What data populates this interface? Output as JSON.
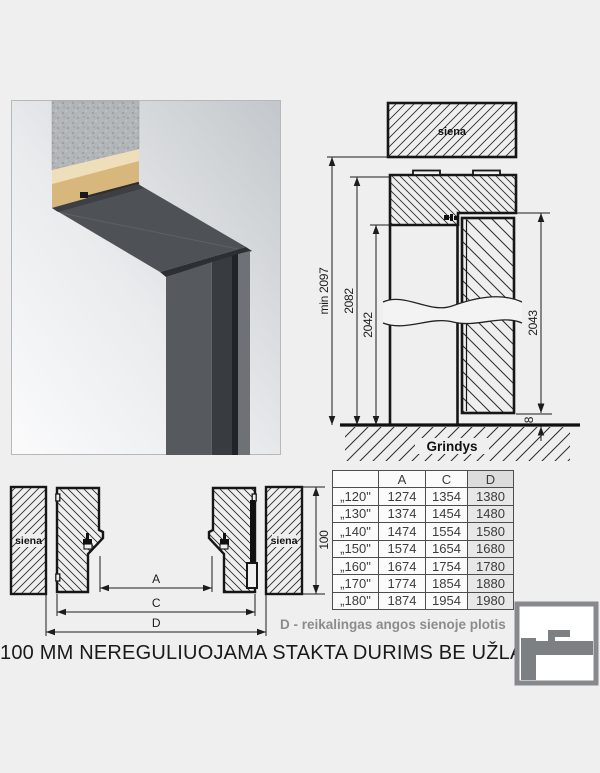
{
  "section_view": {
    "wall_label": "siena",
    "floor_label": "Grindys",
    "dims": {
      "min_total_height": "min 2097",
      "frame_outer_height": "2082",
      "clear_opening_height": "2042",
      "door_leaf_height": "2043",
      "floor_gap": "8"
    }
  },
  "plan_view": {
    "wall_label_left": "siena",
    "wall_label_right": "siena",
    "frame_depth": "100",
    "dim_a_label": "A",
    "dim_c_label": "C",
    "dim_d_label": "D"
  },
  "size_table": {
    "headers": [
      "",
      "A",
      "C",
      "D"
    ],
    "rows": [
      {
        "size": "„120\"",
        "a": "1274",
        "c": "1354",
        "d": "1380"
      },
      {
        "size": "„130\"",
        "a": "1374",
        "c": "1454",
        "d": "1480"
      },
      {
        "size": "„140\"",
        "a": "1474",
        "c": "1554",
        "d": "1580"
      },
      {
        "size": "„150\"",
        "a": "1574",
        "c": "1654",
        "d": "1680"
      },
      {
        "size": "„160\"",
        "a": "1674",
        "c": "1754",
        "d": "1780"
      },
      {
        "size": "„170\"",
        "a": "1774",
        "c": "1854",
        "d": "1880"
      },
      {
        "size": "„180\"",
        "a": "1874",
        "c": "1954",
        "d": "1980"
      }
    ]
  },
  "captions": {
    "d_note": "D - reikalingas angos sienoje plotis",
    "title": "100 MM NEREGULIUOJAMA STAKTA DURIMS BE UŽLAIDOS"
  },
  "colors": {
    "page_bg": "#efefef",
    "drawing_line": "#1c1c1c",
    "note_gray": "#8c8c8c",
    "table_d_column_bg": "#e7e7e7",
    "logo_gray": "#7d8083",
    "frame_dark": "#3a3e43",
    "plaster_tan": "#d8b77d"
  }
}
